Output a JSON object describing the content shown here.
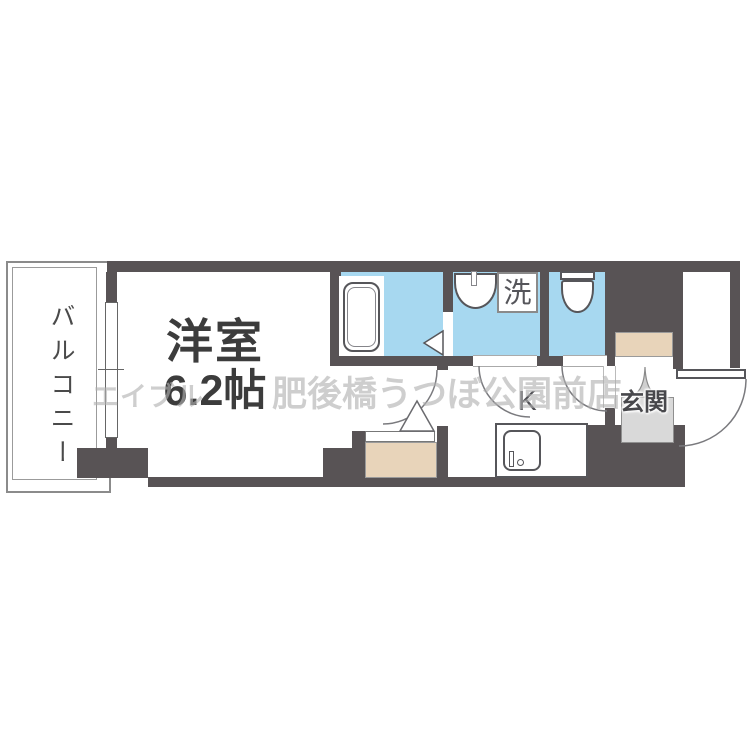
{
  "plan": {
    "title": "1K apartment floor plan",
    "watermark": {
      "agency": "エイブル",
      "branch": "肥後橋うつぼ公園前店"
    },
    "rooms": {
      "balcony": {
        "label": "バルコニー"
      },
      "main_room": {
        "label": "洋室",
        "size_label": "6.2帖"
      },
      "kitchen": {
        "label": "K"
      },
      "entrance": {
        "label": "玄関"
      },
      "laundry": {
        "label": "洗"
      }
    },
    "fixtures": [
      "bathtub",
      "washbasin",
      "washing-machine-pan",
      "toilet",
      "kitchen-sink",
      "shoe-cabinet",
      "closet",
      "entrance-door",
      "sliding-window",
      "door-swing-arcs",
      "folding-door-triangles"
    ],
    "colors": {
      "wall": "#585355",
      "wet_room": "#a7d8f0",
      "storage_beige": "#e8d4ba",
      "entrance_floor": "#d9d9d9",
      "outline": "#777777",
      "label_text": "#3c3c3c",
      "watermark": "#b0b0b0"
    }
  }
}
